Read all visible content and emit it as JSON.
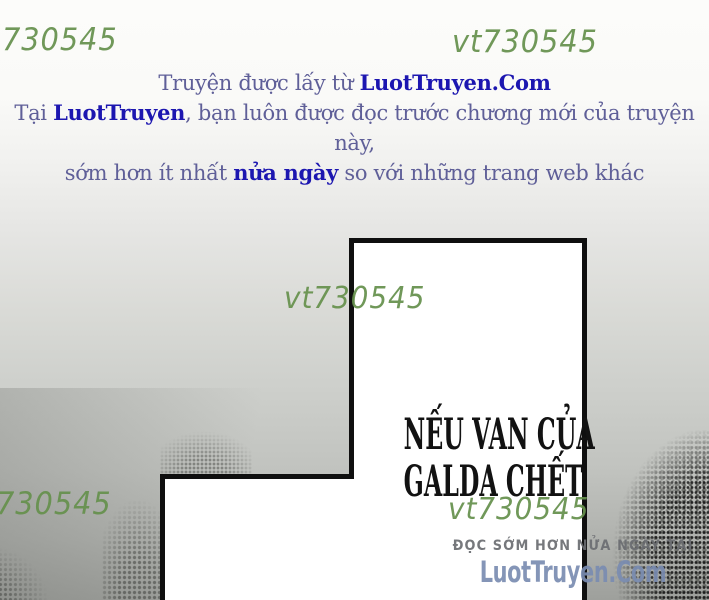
{
  "page": {
    "background_gradient_top": "#fcfcfa",
    "background_gradient_bottom": "#9ea09c"
  },
  "watermarks": {
    "color": "#66914d",
    "top_left": "730545",
    "top_right": "vt730545",
    "middle": "vt730545",
    "bottom_left": "730545",
    "bottom_right": "vt730545"
  },
  "promo_banner": {
    "text_color": "#5f5f98",
    "accent_color": "#1c16b0",
    "line1": {
      "pre": "Truyện được lấy từ ",
      "brand": "LuotTruyen.Com"
    },
    "line2": {
      "pre": "Tại ",
      "brand": "LuotTruyen",
      "post": ", bạn luôn được đọc trước chương mới của truyện này,"
    },
    "line3": {
      "pre": "sớm hơn ít nhất ",
      "brand": "nửa ngày",
      "post": " so với những trang web khác"
    }
  },
  "panel": {
    "fill": "#ffffff",
    "border_color": "#0f0f0f",
    "speech_line1": "NẾU VAN CỦA",
    "speech_line2": "GALDA CHẾT"
  },
  "footer_promo": {
    "tagline": "ĐỌC SỚM HƠN NỬA NGÀY TẠI",
    "tagline_color": "#6a6d71",
    "site": "LuotTruyen.Com",
    "site_color": "#7a8cb1"
  }
}
